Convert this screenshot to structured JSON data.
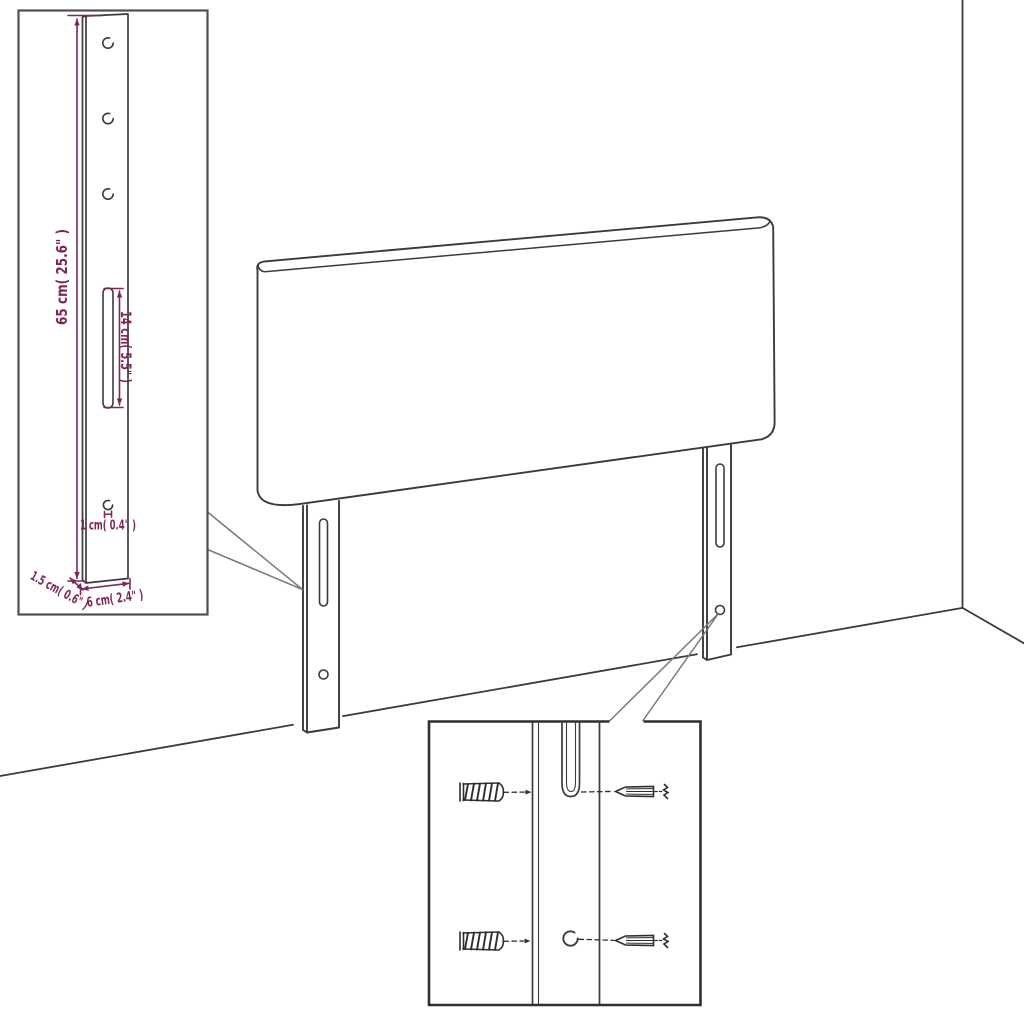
{
  "colors": {
    "line": "#3b3b3b",
    "dimension": "#7e2657",
    "callout": "#7a7a7a",
    "hardware": "#2e2e2e",
    "inset_border": "#4f4f4f",
    "inset_border_dark": "#2f2f2f",
    "background": "#ffffff"
  },
  "leg_detail_inset": {
    "measurements": {
      "leg_height": "65 cm( 25.6\" )",
      "slot_length": "14 cm( 5.5\" )",
      "hole_diameter": "1 cm( 0.4\" )",
      "leg_depth": "1.5 cm( 0.6\" )",
      "leg_width": "6 cm( 2.4\" )"
    }
  }
}
